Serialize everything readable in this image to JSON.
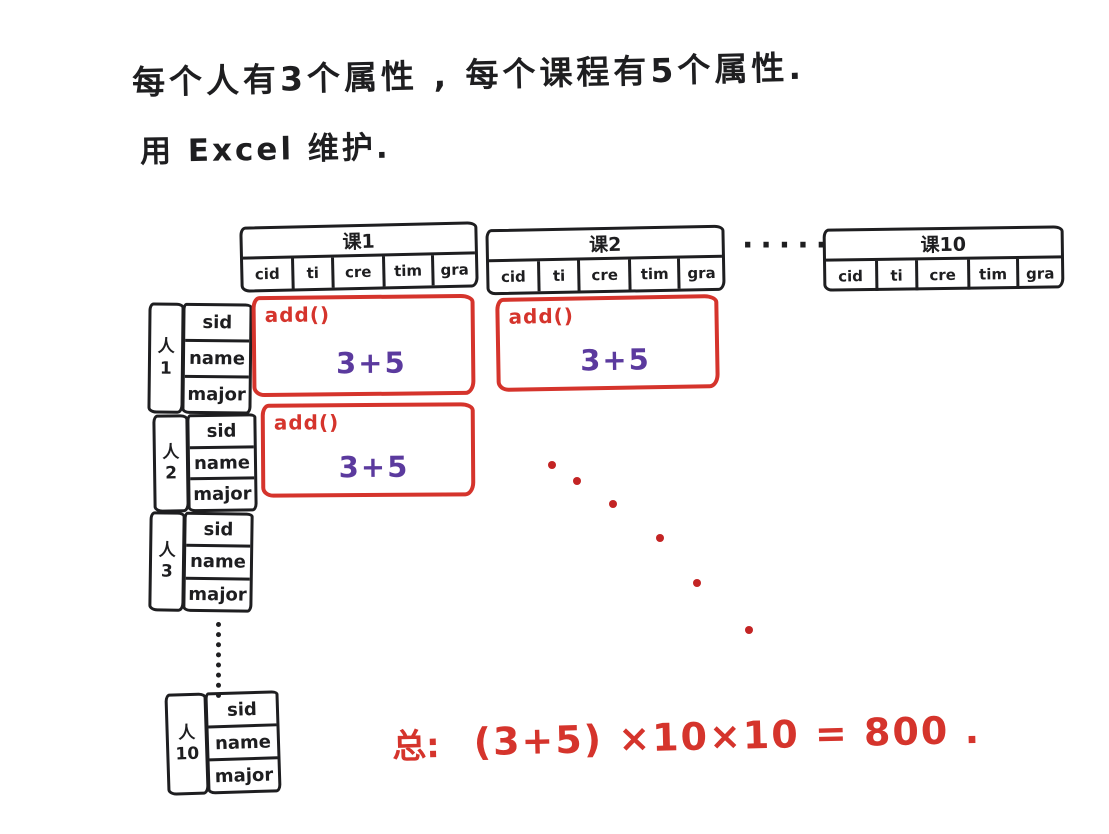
{
  "notes": {
    "line1": "每个人有3个属性 , 每个课程有5个属性.",
    "line2": "用 Excel 维护."
  },
  "course_tables": [
    {
      "header": "课1",
      "columns": [
        "cid",
        "ti",
        "cre",
        "tim",
        "gra"
      ]
    },
    {
      "header": "课2",
      "columns": [
        "cid",
        "ti",
        "cre",
        "tim",
        "gra"
      ]
    },
    {
      "header": "课10",
      "columns": [
        "cid",
        "ti",
        "cre",
        "tim",
        "gra"
      ]
    }
  ],
  "course_ellipsis": "·····",
  "person_tables": [
    {
      "label": "人",
      "num": "1",
      "rows": [
        "sid",
        "name",
        "major"
      ]
    },
    {
      "label": "人",
      "num": "2",
      "rows": [
        "sid",
        "name",
        "major"
      ]
    },
    {
      "label": "人",
      "num": "3",
      "rows": [
        "sid",
        "name",
        "major"
      ]
    },
    {
      "label": "人",
      "num": "10",
      "rows": [
        "sid",
        "name",
        "major"
      ]
    }
  ],
  "add_boxes": [
    {
      "func": "add()",
      "value": "3+5"
    },
    {
      "func": "add()",
      "value": "3+5"
    },
    {
      "func": "add()",
      "value": "3+5"
    }
  ],
  "summary": {
    "prefix": "总:",
    "formula": "(3+5) ×10×10 = 800 ."
  },
  "colors": {
    "ink": "#1e1e20",
    "red": "#d5342c",
    "purple": "#5b3a9e",
    "paper": "#ffffff"
  }
}
